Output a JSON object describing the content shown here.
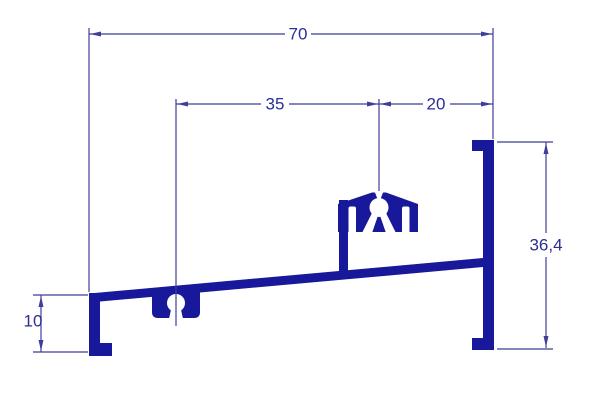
{
  "diagram": {
    "title": "aluminium-profile-cross-section",
    "units": "mm",
    "colors": {
      "profile": "#18189a",
      "dimension": "#3f3f99",
      "text": "#2d2d96",
      "background": "#ffffff"
    },
    "dimensions": {
      "total_width": {
        "label": "70",
        "value": 70
      },
      "left_span": {
        "label": "35",
        "value": 35
      },
      "right_span": {
        "label": "20",
        "value": 20
      },
      "right_height": {
        "label": "36,4",
        "value": 36.4
      },
      "left_height": {
        "label": "10",
        "value": 10
      }
    }
  }
}
